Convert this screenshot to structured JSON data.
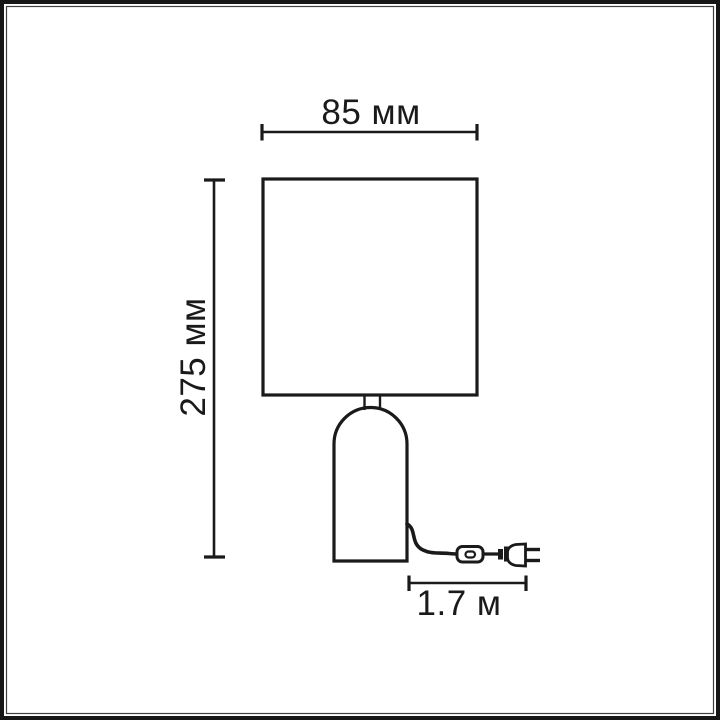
{
  "image": {
    "background_color": "#ffffff",
    "ink_color": "#1a1a1a",
    "frame_outer_color": "#161616",
    "frame_inner_line_color": "#3f3f3f"
  },
  "dimensions": {
    "shade_width": "85 мм",
    "lamp_height": "275 мм",
    "cord_length": "1.7 м"
  }
}
